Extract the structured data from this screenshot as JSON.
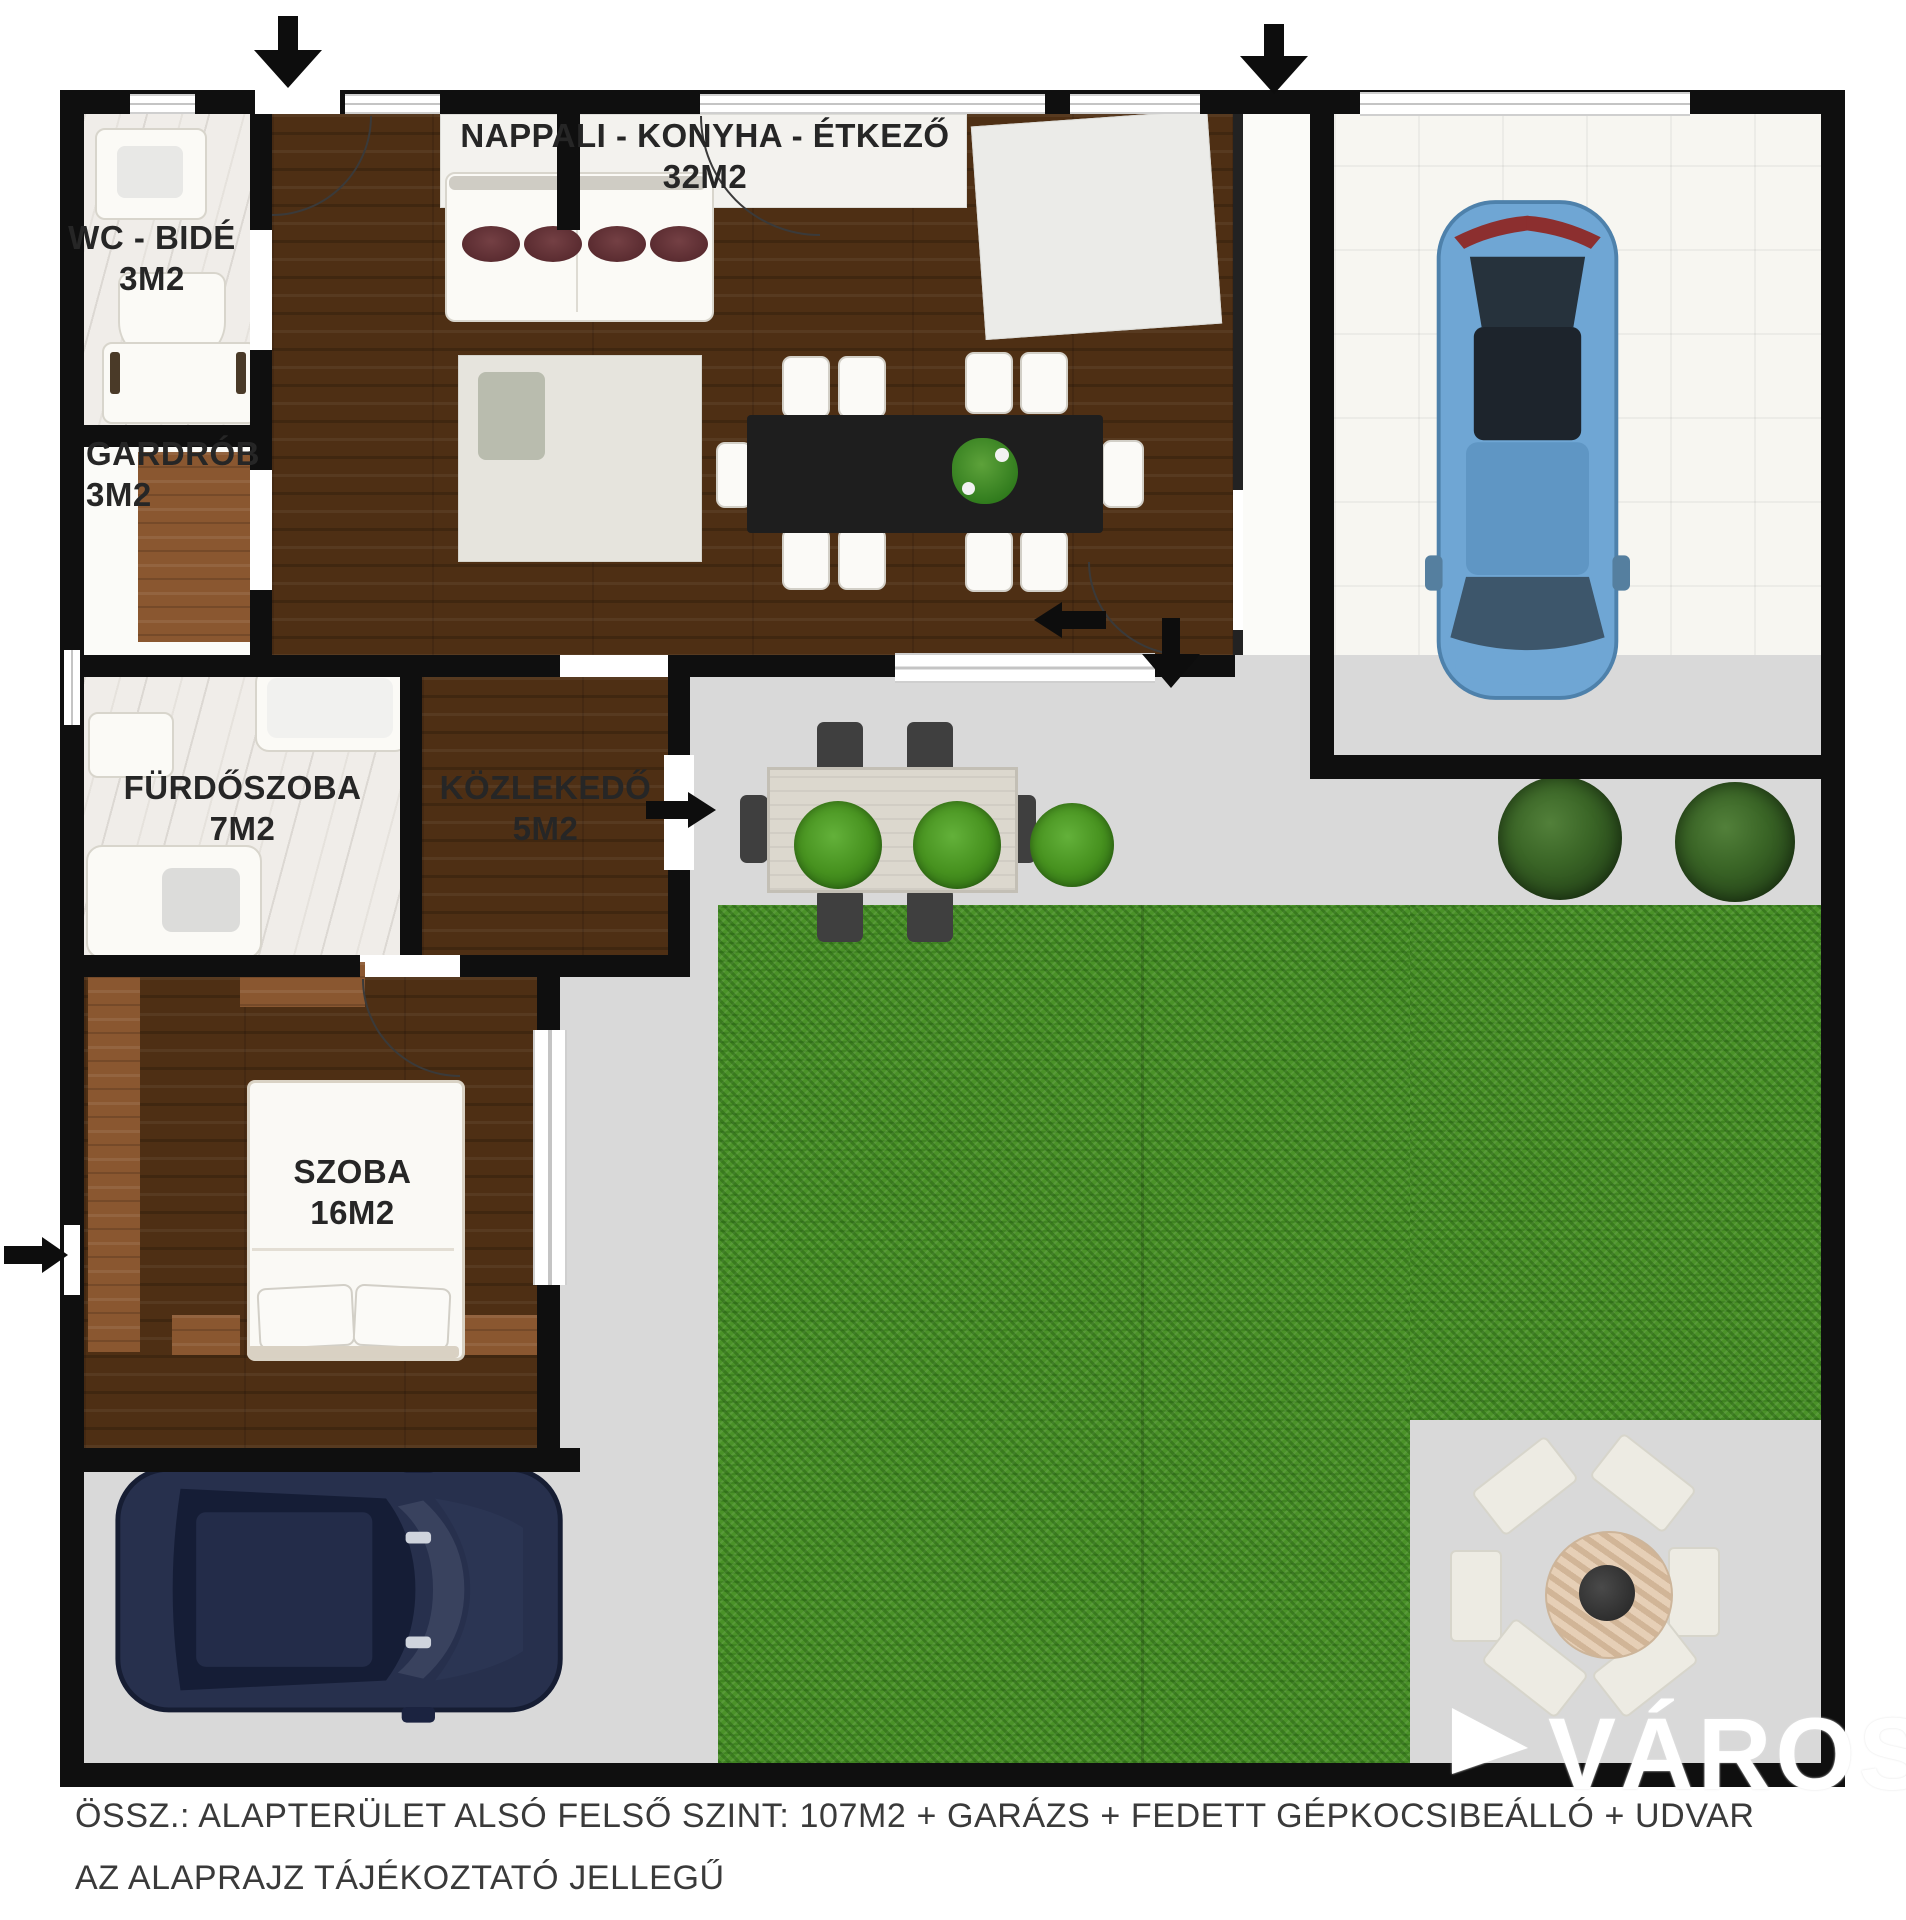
{
  "plan": {
    "rooms": [
      {
        "label": "NAPPALI - KONYHA - ÉTKEZŐ",
        "area": "32M2"
      },
      {
        "label": "WC - BIDÉ",
        "area": "3M2"
      },
      {
        "label": "GARDRÓB",
        "area": "3M2"
      },
      {
        "label": "FÜRDŐSZOBA",
        "area": "7M2"
      },
      {
        "label": "KÖZLEKEDŐ",
        "area": "5M2"
      },
      {
        "label": "SZOBA",
        "area": "16M2"
      }
    ],
    "footer": {
      "line1": "ÖSSZ.: ALAPTERÜLET ALSÓ FELSŐ SZINT: 107M2 + GARÁZS + FEDETT GÉPKOCSIBEÁLLÓ + UDVAR",
      "line2": "AZ ALAPRAJZ TÁJÉKOZTATÓ JELLEGŰ"
    },
    "watermark": "VÁROS",
    "colors": {
      "wall": "#0f0f0f",
      "wood_dark": "#4e2f14",
      "wood_light": "#8a5730",
      "marble": "#f0ede9",
      "garage_tile": "#f7f6f1",
      "yard_gray": "#d9d9d9",
      "grass": "#4a9228",
      "car_blue": "#6fa6d4",
      "car_navy": "#27304d"
    }
  }
}
